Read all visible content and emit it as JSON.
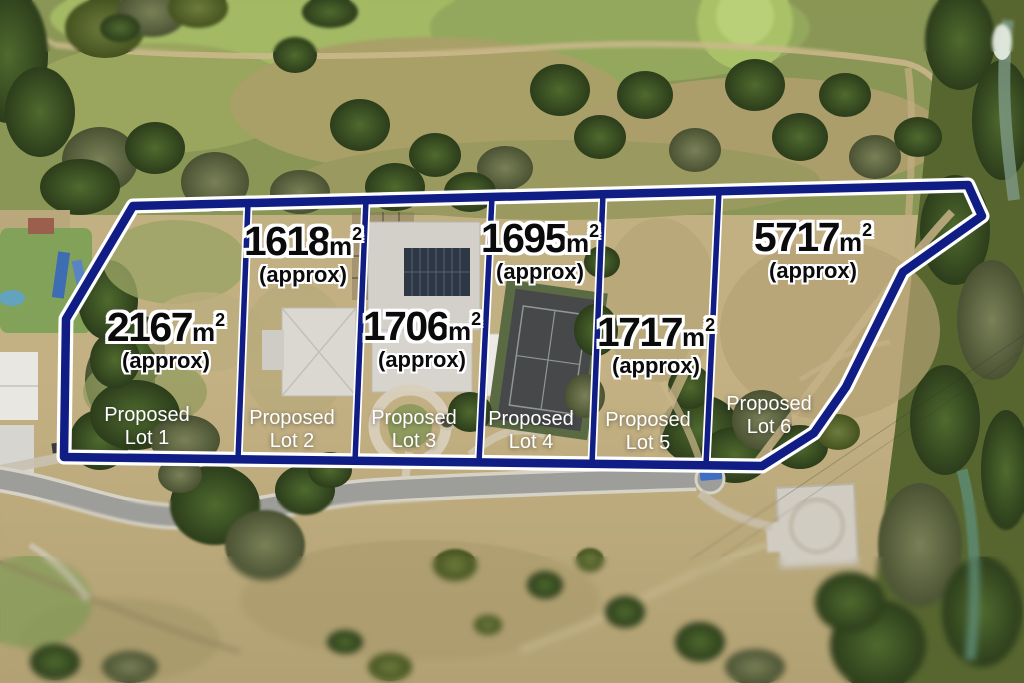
{
  "colors": {
    "boundary_navy": "#101d85",
    "boundary_casing": "#ffffff",
    "area_text": "#0b0b0b",
    "area_outline": "#ffffff",
    "lot_name_text": "#ffffff"
  },
  "lots": [
    {
      "name": "Proposed Lot 1",
      "area_value": "2167",
      "area_unit": "m",
      "area_exponent": "2",
      "approx_label": "(approx)",
      "name_line1": "Proposed",
      "name_line2": "Lot 1"
    },
    {
      "name": "Proposed Lot 2",
      "area_value": "1618",
      "area_unit": "m",
      "area_exponent": "2",
      "approx_label": "(approx)",
      "name_line1": "Proposed",
      "name_line2": "Lot 2"
    },
    {
      "name": "Proposed Lot 3",
      "area_value": "1706",
      "area_unit": "m",
      "area_exponent": "2",
      "approx_label": "(approx)",
      "name_line1": "Proposed",
      "name_line2": "Lot 3"
    },
    {
      "name": "Proposed Lot 4",
      "area_value": "1695",
      "area_unit": "m",
      "area_exponent": "2",
      "approx_label": "(approx)",
      "name_line1": "Proposed",
      "name_line2": "Lot 4"
    },
    {
      "name": "Proposed Lot 5",
      "area_value": "1717",
      "area_unit": "m",
      "area_exponent": "2",
      "approx_label": "(approx)",
      "name_line1": "Proposed",
      "name_line2": "Lot 5"
    },
    {
      "name": "Proposed Lot 6",
      "area_value": "5717",
      "area_unit": "m",
      "area_exponent": "2",
      "approx_label": "(approx)",
      "name_line1": "Proposed",
      "name_line2": "Lot 6"
    }
  ]
}
